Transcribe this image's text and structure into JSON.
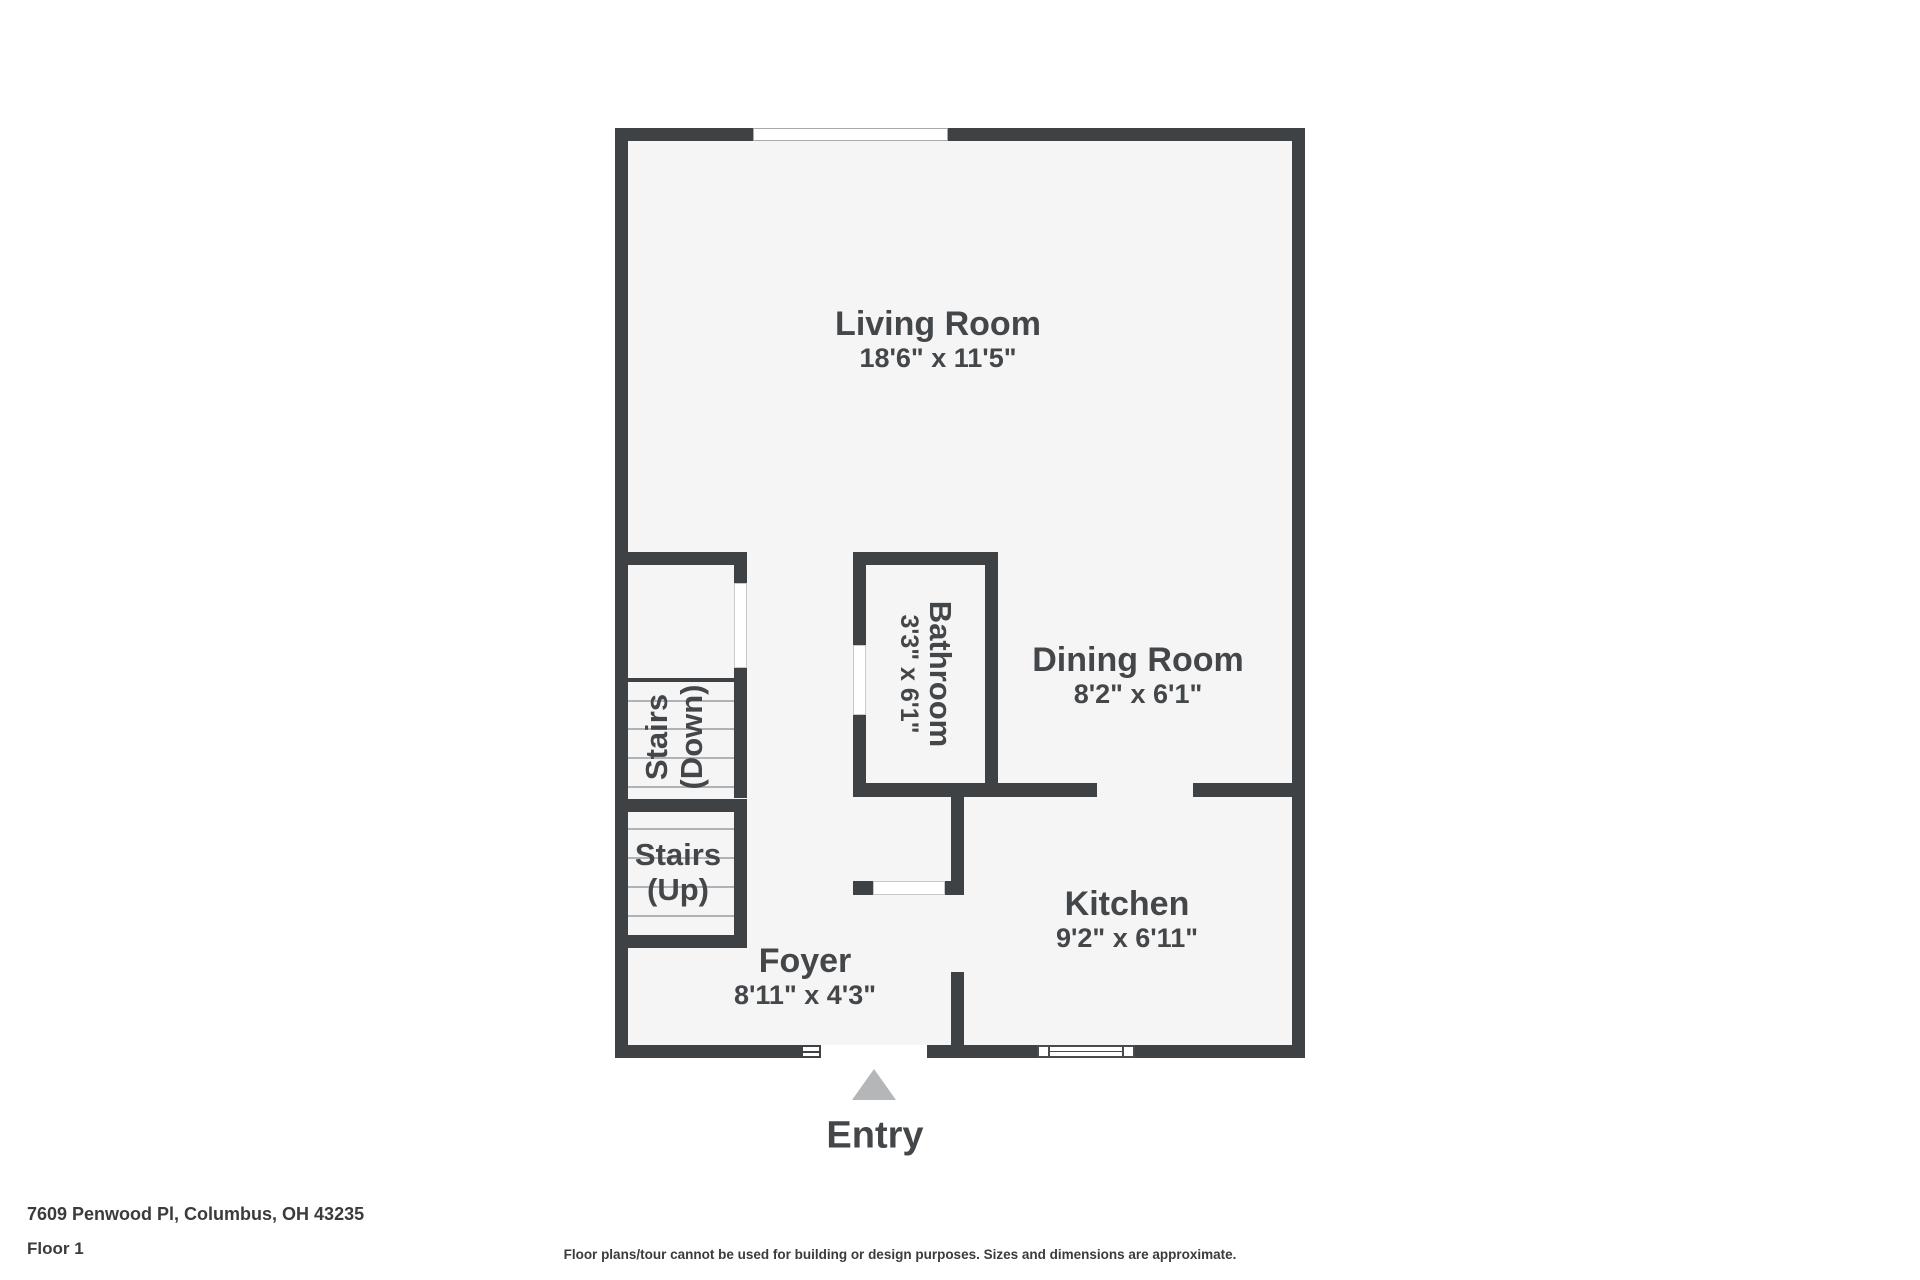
{
  "colors": {
    "wall": "#3e4245",
    "floor": "#f5f5f6",
    "background": "#ffffff",
    "label": "#44474a",
    "entry_arrow": "#b4b6b8",
    "footer_text": "#3b3b3b",
    "window_border": "#a9a9a9",
    "tread_line": "#b0b3b5"
  },
  "rooms": {
    "living": {
      "name": "Living Room",
      "dims": "18'6\" x 11'5\""
    },
    "dining": {
      "name": "Dining Room",
      "dims": "8'2\" x 6'1\""
    },
    "kitchen": {
      "name": "Kitchen",
      "dims": "9'2\" x 6'11\""
    },
    "foyer": {
      "name": "Foyer",
      "dims": "8'11\" x 4'3\""
    },
    "bathroom": {
      "name": "Bathroom",
      "dims": "3'3\" x 6'1\""
    },
    "stairs_up": {
      "line1": "Stairs",
      "line2": "(Up)"
    },
    "stairs_down": {
      "line1": "Stairs",
      "line2": "(Down)"
    }
  },
  "entry": {
    "label": "Entry"
  },
  "footer": {
    "address": "7609 Penwood Pl, Columbus, OH 43235",
    "floor": "Floor 1",
    "disclaimer": "Floor plans/tour cannot be used for building or design purposes. Sizes and dimensions are approximate."
  }
}
